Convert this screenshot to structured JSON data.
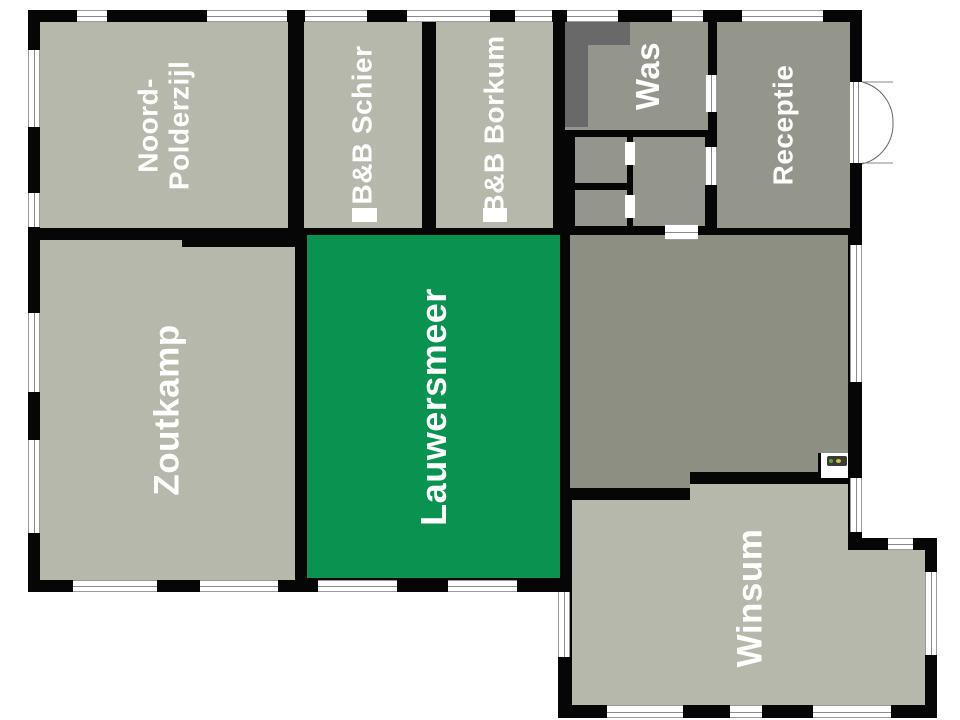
{
  "floorplan": {
    "rooms": {
      "noord_polderzijl": {
        "label_line1": "Noord-",
        "label_line2": "Polderzijl",
        "color": "#b6b8ac"
      },
      "bb_schier": {
        "label": "B&B Schier",
        "color": "#b6b8ac"
      },
      "bb_borkum": {
        "label": "B&B Borkum",
        "color": "#b6b8ac"
      },
      "was": {
        "label": "Was",
        "color": "#94968c"
      },
      "receptie": {
        "label": "Receptie",
        "color": "#94968c"
      },
      "zoutkamp": {
        "label": "Zoutkamp",
        "color": "#b6b8ac"
      },
      "lauwersmeer": {
        "label": "Lauwersmeer",
        "color": "#0a9251",
        "highlighted": true
      },
      "winsum": {
        "label": "Winsum",
        "color": "#b6b8ac"
      }
    },
    "unlabeled_rooms": [
      {
        "name": "central-hall-room",
        "color": "#8d8f83"
      },
      {
        "name": "hallway",
        "color": "#94968c"
      },
      {
        "name": "toilet-upper",
        "color": "#94968c"
      },
      {
        "name": "toilet-lower",
        "color": "#94968c"
      }
    ],
    "colors": {
      "wall": "#060606",
      "room_light": "#b6b8ac",
      "room_medium": "#94968c",
      "room_dark": "#8d8f83",
      "highlight_green": "#0a9251",
      "counter_dark": "#696969",
      "window_line": "#8a8a8a",
      "label_text": "#ffffff",
      "background": "#ffffff"
    }
  }
}
